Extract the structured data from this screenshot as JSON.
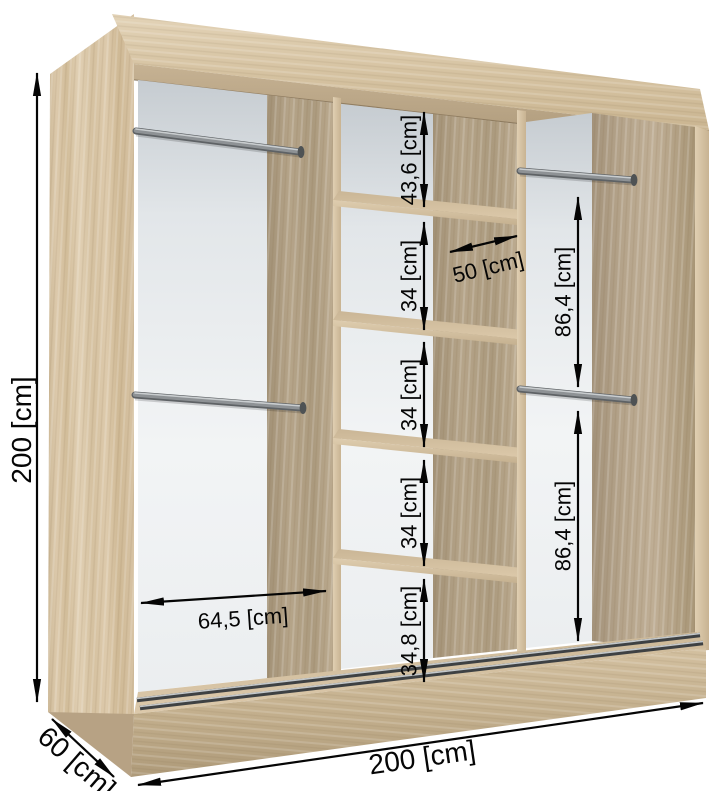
{
  "diagram": {
    "type": "furniture-dimension-diagram",
    "subject": "sliding-wardrobe-interior",
    "unit": "cm",
    "labels": {
      "height": "200 [cm]",
      "depth": "60 [cm]",
      "width": "200 [cm]",
      "shelf_column": [
        "43,6 [cm]",
        "34 [cm]",
        "34 [cm]",
        "34 [cm]",
        "34,8 [cm]"
      ],
      "shelf_width": "50 [cm]",
      "left_section_width": "64,5 [cm]",
      "right_hanging_heights": [
        "86,4 [cm]",
        "86,4 [cm]"
      ]
    },
    "values": {
      "height_cm": 200,
      "depth_cm": 60,
      "width_cm": 200,
      "middle_column_compartments_cm": [
        43.6,
        34,
        34,
        34,
        34.8
      ],
      "middle_shelf_width_cm": 50,
      "left_section_width_cm": 64.5,
      "right_hanging_heights_cm": [
        86.4,
        86.4
      ]
    },
    "colors": {
      "wood_light": "#d8c5a6",
      "wood_mid": "#c9b493",
      "wood_dark": "#ab9a7e",
      "back_panel": "#eef1f3",
      "metal": "#8d9194",
      "dimension": "#050505",
      "background": "#ffffff"
    }
  }
}
